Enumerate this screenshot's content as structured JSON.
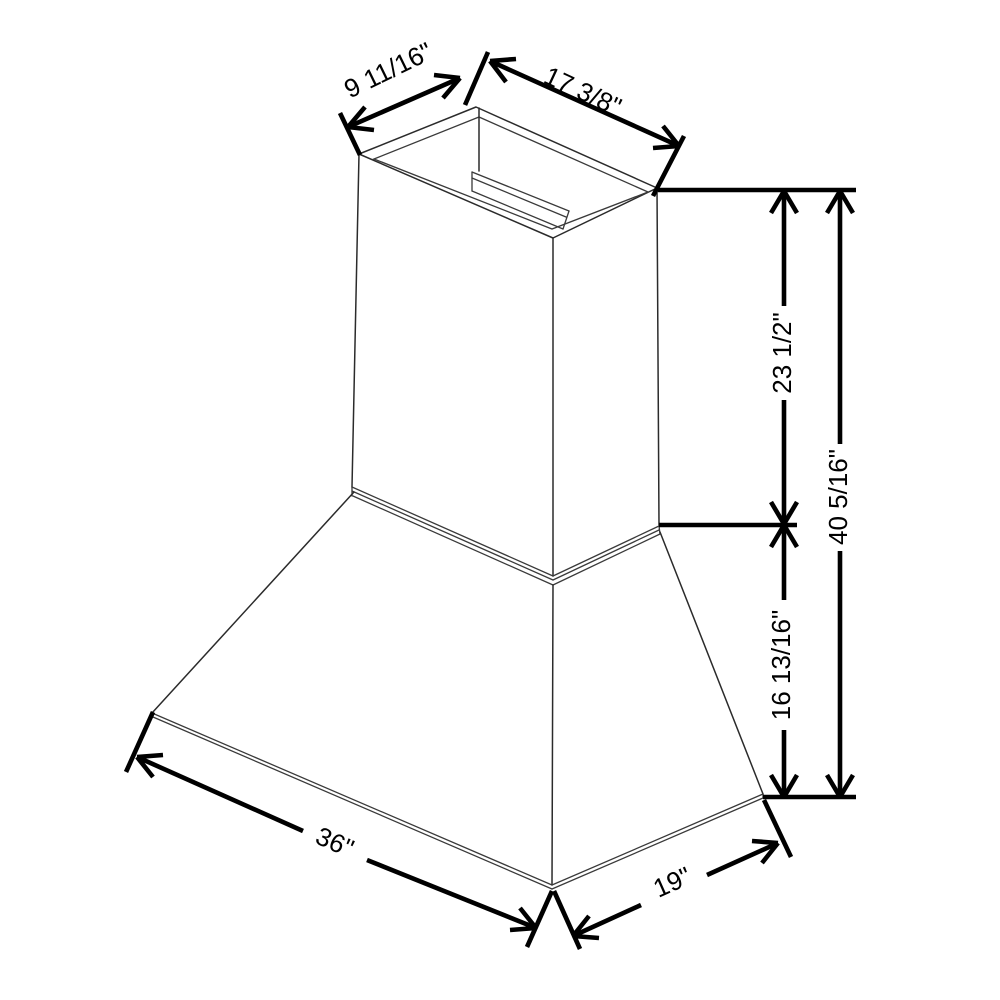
{
  "diagram": {
    "background_color": "#ffffff",
    "line_color": "#000000",
    "subject": "wall-mount-range-hood-isometric-dimension-drawing",
    "labels": {
      "top_depth": "9 11/16\"",
      "top_width": "17 3/8\"",
      "chimney_height": "23 1/2\"",
      "overall_height": "40 5/16\"",
      "canopy_height": "16 13/16\"",
      "bottom_width": "36\"",
      "bottom_depth": "19\""
    }
  }
}
